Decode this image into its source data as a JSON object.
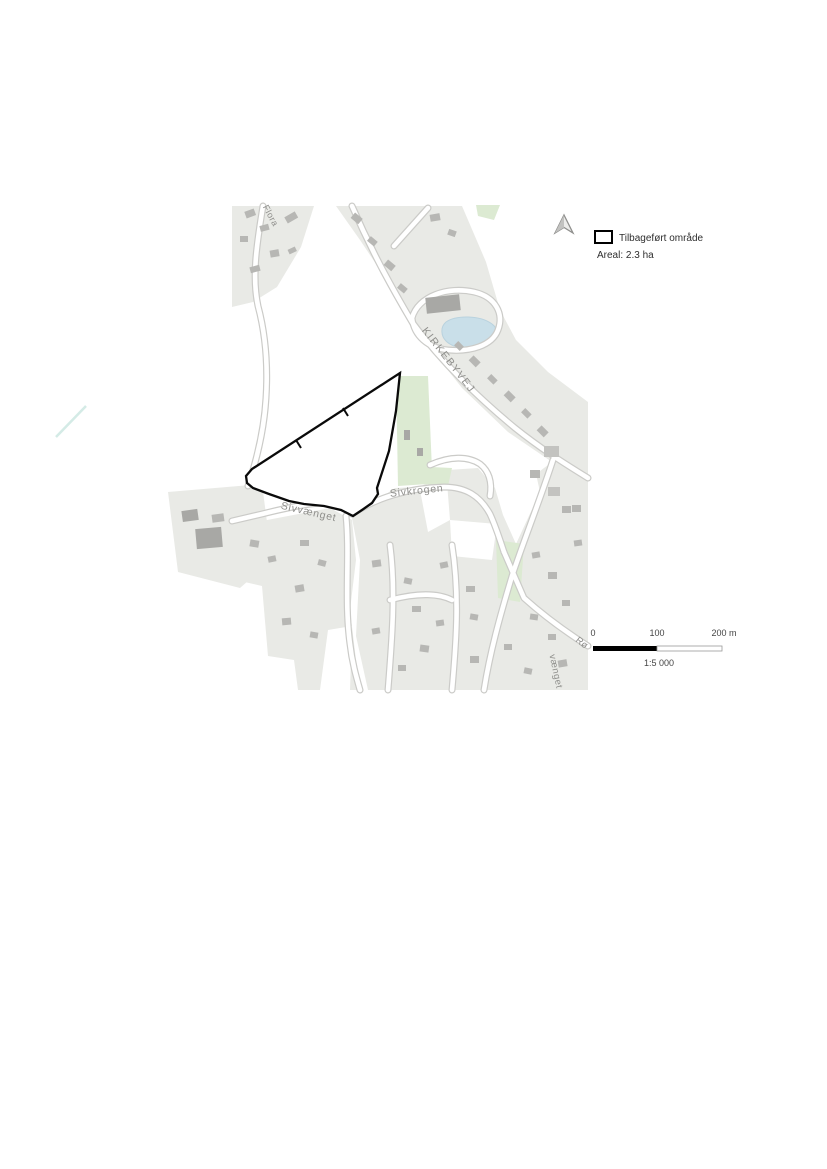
{
  "legend": {
    "swatch_label": "Tilbageført område",
    "area_label": "Areal: 2.3 ha",
    "swatch_fill": "#ffffff",
    "swatch_border": "#000000",
    "north_arrow": "north-arrow"
  },
  "scale_bar": {
    "tick_0": "0",
    "tick_100": "100",
    "tick_200": "200 m",
    "ratio_label": "1:5 000",
    "segment_colors": [
      "#000000",
      "#ffffff"
    ]
  },
  "map": {
    "site": {
      "name": "Tilbageført område",
      "area_ha": "2.3",
      "outline_color": "#000000"
    },
    "street_labels": [
      {
        "name": "KIRKEBYVEJ"
      },
      {
        "name": "Sivkrogen"
      },
      {
        "name": "Sivvænget"
      },
      {
        "name": "Flora"
      },
      {
        "name": "vænget"
      },
      {
        "name": "Rø"
      }
    ],
    "colors": {
      "parcel": "#e9eae6",
      "building": "#b7b7b4",
      "road_fill": "#ffffff",
      "road_casing": "#cbcbc8",
      "green": "#dcead2",
      "water": "#c9dfe9",
      "stream": "#d4ebe6",
      "label": "#8f8f8c"
    }
  }
}
